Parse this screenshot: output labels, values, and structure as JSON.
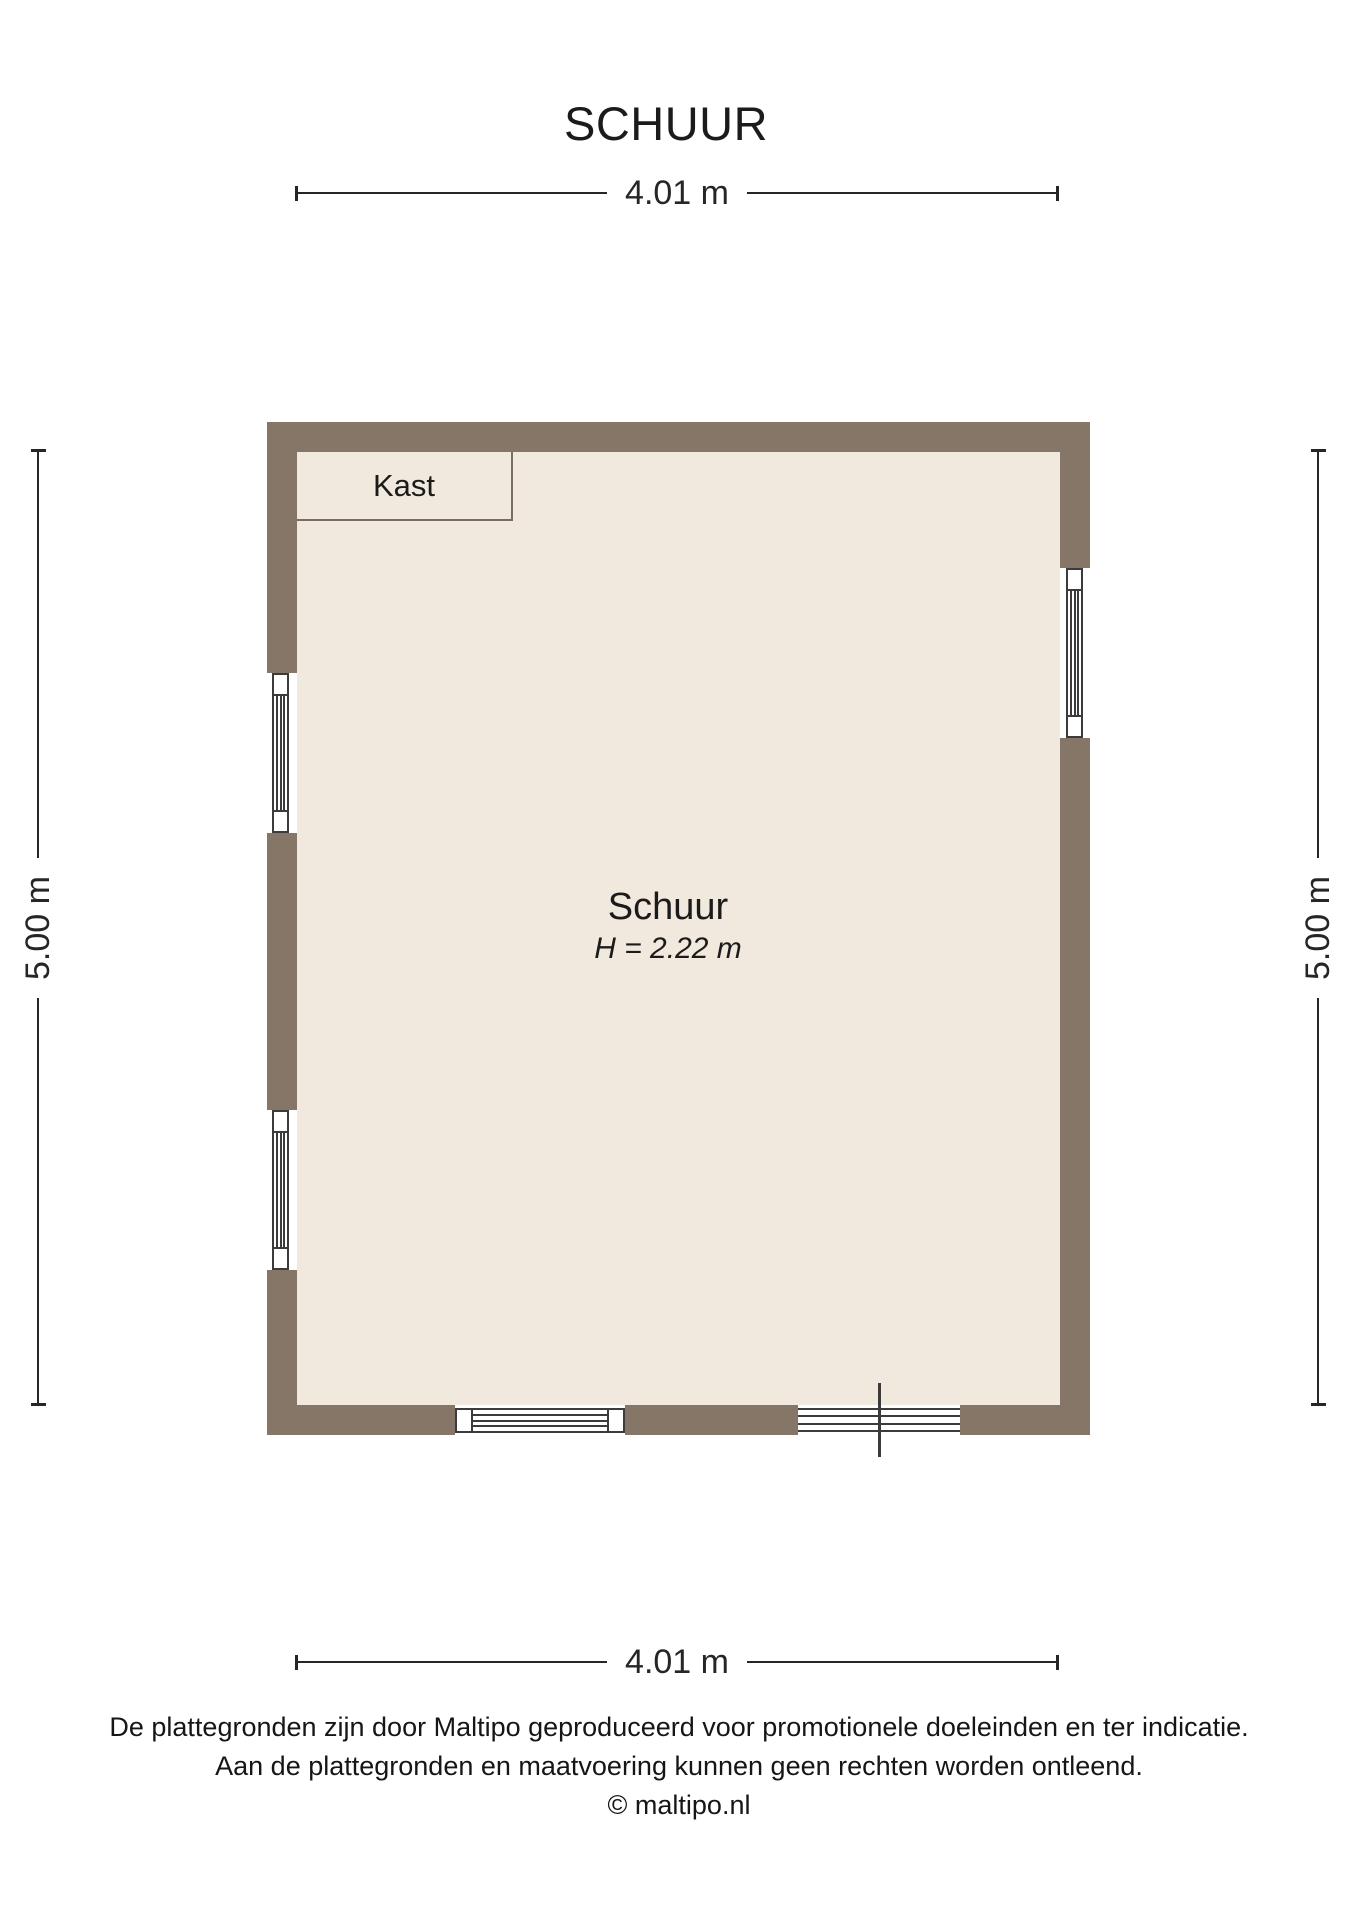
{
  "title": "SCHUUR",
  "plan": {
    "rooms": {
      "kast": {
        "label": "Kast"
      },
      "schuur": {
        "label": "Schuur",
        "height_note": "H = 2.22 m"
      }
    }
  },
  "dimensions": {
    "top": "4.01 m",
    "bottom": "4.01 m",
    "left": "5.00 m",
    "right": "5.00 m"
  },
  "footer": {
    "line1": "De plattegronden zijn door Maltipo geproduceerd voor promotionele doeleinden en ter indicatie.",
    "line2": "Aan de plattegronden en maatvoering kunnen geen rechten worden ontleend.",
    "line3": "© maltipo.nl"
  },
  "colors": {
    "wall": "#857668",
    "floor": "#f1e9dd",
    "symbol_line": "#3b3b3b",
    "dimension_line": "#262626"
  }
}
